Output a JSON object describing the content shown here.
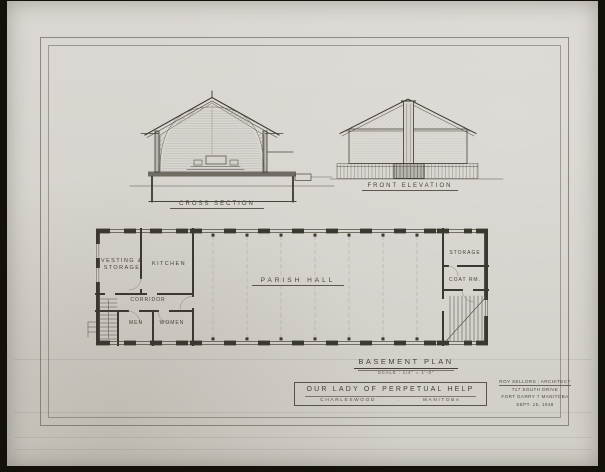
{
  "colors": {
    "background": "#14100a",
    "paper": "#d6d3cd",
    "ink": "#474338",
    "wall": "#3b382f"
  },
  "cross_section": {
    "caption": "CROSS SECTION"
  },
  "front_elevation": {
    "caption": "FRONT ELEVATION"
  },
  "basement_plan": {
    "caption": "BASEMENT PLAN",
    "scale_note": "SCALE : 1/4\" = 1'-0\"",
    "rooms": {
      "vesting_line1": "VESTING &",
      "vesting_line2": "STORAGE",
      "kitchen": "KITCHEN",
      "corridor": "CORRIDOR",
      "men": "MEN",
      "women": "WOMEN",
      "parish_hall": "PARISH HALL",
      "storage": "STORAGE",
      "coat_room": "COAT RM."
    }
  },
  "title_block": {
    "project": "OUR LADY OF PERPETUAL HELP",
    "location": "CHARLESWOOD",
    "separator": ".",
    "province": "MANITOBA"
  },
  "architect_block": {
    "name": "ROY SELLORS : ARCHITECT",
    "address1": "717 SOUTH DRIVE",
    "address2": "FORT GARRY 7  MANITOBA",
    "date": "SEPT. 15, 1948"
  }
}
